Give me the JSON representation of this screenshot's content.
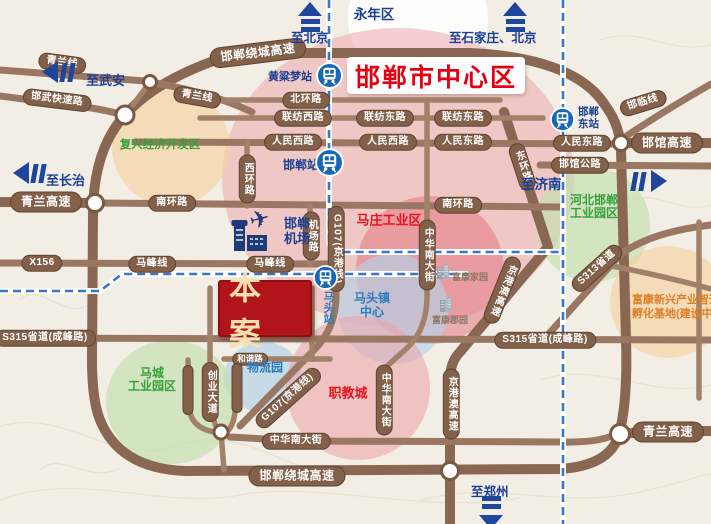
{
  "title": "邯郸市中心区",
  "project": "本案",
  "pills": [
    "青兰线",
    "青兰线",
    "邯武快速路",
    "邯郸绕城高速",
    "北环路",
    "联纺西路",
    "联纺东路",
    "联纺东路",
    "人民西路",
    "人民西路",
    "人民东路",
    "人民东路",
    "邯临线",
    "邯馆高速",
    "邯馆公路",
    "西环路",
    "东环路",
    "青兰高速",
    "南环路",
    "南环路",
    "机场路",
    "G107(京港线)",
    "G107(京港线)",
    "X156",
    "马峰线",
    "马峰线",
    "S315省道(成峰路)",
    "S315省道(成峰路)",
    "S313省道",
    "京港澳高速",
    "京港澳高速",
    "中华南大街",
    "中华南大街",
    "中华南大街",
    "创业大道",
    "和谐路",
    "邯郸绕城高速",
    "青兰高速"
  ],
  "districts": {
    "yongnian": "永年区",
    "fuxing": "复兴经济开发区",
    "hebei1": "河北邯郸",
    "hebei2": "工业园区",
    "mazhuang": "马庄工业区",
    "matou1": "马头镇",
    "matou2": "中心",
    "wuliu": "物流园",
    "macheng1": "马城",
    "macheng2": "工业园区",
    "zhijiao": "职教城",
    "fukang1": "富康新兴产业智造",
    "fukang2": "孵化基地(建设中"
  },
  "stations": {
    "huangliangmeng": "黄粱梦站",
    "handan": "邯郸站",
    "handandong1": "邯郸",
    "handandong2": "东站",
    "matou": "马头站"
  },
  "airport": {
    "line1": "邯郸",
    "line2": "机场"
  },
  "arrows": {
    "wuan": "至武安",
    "beijing": "至北京",
    "shijiazhuang": "至石家庄、北京",
    "changzhi": "至长治",
    "jinan": "至济南",
    "zhengzhou": "至郑州"
  },
  "buildings": {
    "b1": "富康家园",
    "b2": "富康郡园"
  },
  "colors": {
    "road": "#8a6752",
    "rail": "#3a77c2",
    "red": "#e8141f",
    "green": "#36a03a",
    "blue": "#2d7bc0",
    "orange": "#dd7f28",
    "navy": "#1c3f94"
  }
}
